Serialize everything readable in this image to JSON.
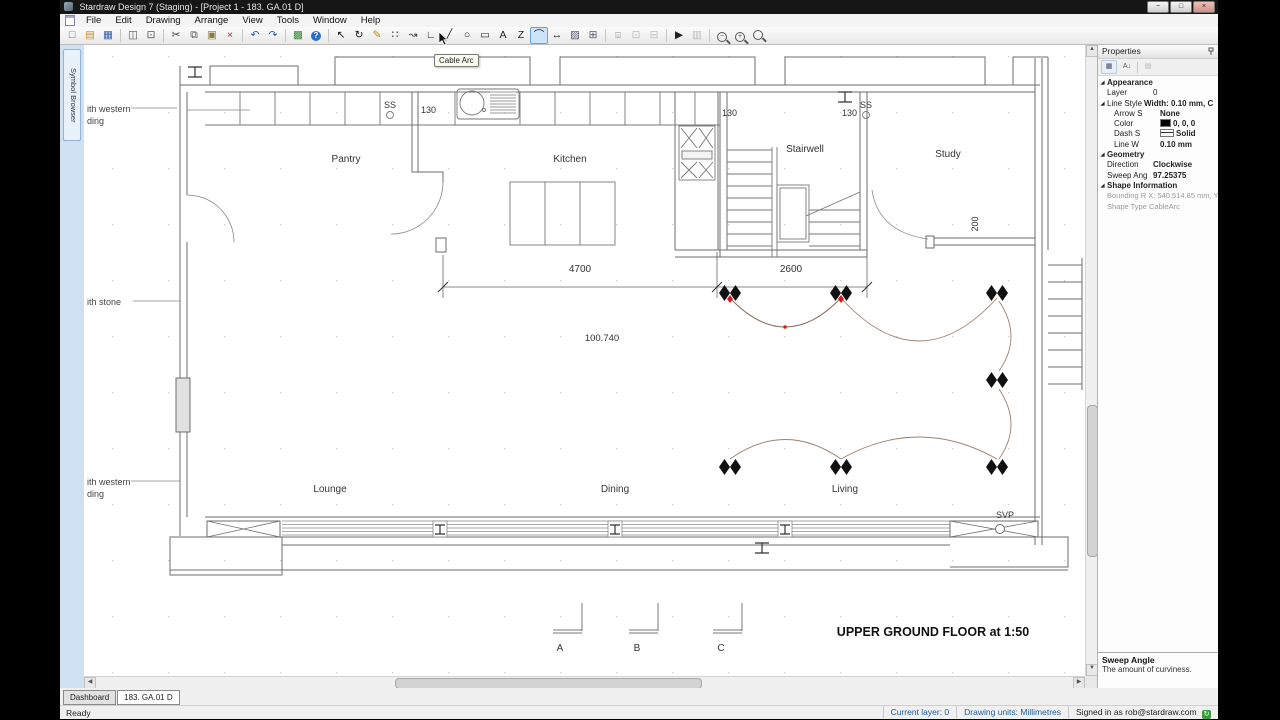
{
  "window": {
    "title": "Stardraw Design 7 (Staging) - [Project 1 - 183. GA.01 D]",
    "controls": {
      "minimize": "−",
      "maximize": "□",
      "close": "×"
    }
  },
  "menu": {
    "items": [
      "File",
      "Edit",
      "Drawing",
      "Arrange",
      "View",
      "Tools",
      "Window",
      "Help"
    ]
  },
  "toolbar": {
    "tooltip": "Cable Arc",
    "icons": [
      {
        "n": "new-icon",
        "g": "□",
        "c": "#666"
      },
      {
        "n": "open-icon",
        "g": "▤",
        "c": "#c8922e"
      },
      {
        "n": "save-icon",
        "g": "▦",
        "c": "#2f5fa8"
      },
      {
        "t": "sep"
      },
      {
        "n": "print-icon",
        "g": "◫",
        "c": "#555"
      },
      {
        "n": "print-preview-icon",
        "g": "⊡",
        "c": "#555"
      },
      {
        "t": "sep"
      },
      {
        "n": "cut-icon",
        "g": "✂",
        "c": "#444"
      },
      {
        "n": "copy-icon",
        "g": "⧉",
        "c": "#555"
      },
      {
        "n": "paste-icon",
        "g": "▣",
        "c": "#8a7a3a"
      },
      {
        "n": "delete-icon",
        "g": "×",
        "c": "#b03030"
      },
      {
        "t": "sep"
      },
      {
        "n": "undo-icon",
        "g": "↶",
        "c": "#2f5fa8"
      },
      {
        "n": "redo-icon",
        "g": "↷",
        "c": "#2f5fa8"
      },
      {
        "t": "sep"
      },
      {
        "n": "insert-picture-icon",
        "g": "▩",
        "c": "#3a8a3a"
      },
      {
        "n": "help-icon",
        "t": "help",
        "g": "?"
      },
      {
        "t": "sep"
      },
      {
        "n": "select-icon",
        "g": "↖",
        "c": "#111"
      },
      {
        "n": "rotate-icon",
        "g": "↻",
        "c": "#111"
      },
      {
        "n": "format-painter-icon",
        "g": "✎",
        "c": "#b8860b"
      },
      {
        "n": "node-edit-icon",
        "g": "∷",
        "c": "#333"
      },
      {
        "n": "curve-select-icon",
        "g": "↝",
        "c": "#333"
      },
      {
        "n": "corner-line-icon",
        "g": "∟",
        "c": "#222"
      },
      {
        "n": "line-icon",
        "g": "╱",
        "c": "#222"
      },
      {
        "n": "ellipse-icon",
        "g": "○",
        "c": "#222"
      },
      {
        "n": "rectangle-icon",
        "g": "▭",
        "c": "#222"
      },
      {
        "n": "text-icon",
        "g": "A",
        "c": "#222"
      },
      {
        "n": "polyline-icon",
        "g": "Z",
        "c": "#222"
      },
      {
        "n": "cable-arc-icon",
        "g": "⌒",
        "c": "#222",
        "active": true
      },
      {
        "n": "dimension-icon",
        "g": "↔",
        "c": "#222"
      },
      {
        "n": "image-icon",
        "g": "▨",
        "c": "#556"
      },
      {
        "n": "symbol-grid-icon",
        "g": "⊞",
        "c": "#556"
      },
      {
        "t": "sep"
      },
      {
        "n": "group-icon",
        "g": "⧈",
        "c": "#555",
        "dis": true
      },
      {
        "n": "ungroup-icon",
        "g": "⊡",
        "c": "#555",
        "dis": true
      },
      {
        "n": "regroup-icon",
        "g": "⊟",
        "c": "#555",
        "dis": true
      },
      {
        "t": "sep"
      },
      {
        "n": "pick-icon",
        "g": "▶",
        "c": "#222"
      },
      {
        "n": "measure-icon",
        "g": "▥",
        "c": "#555",
        "dis": true
      },
      {
        "t": "sep"
      },
      {
        "n": "zoom-out-icon",
        "t": "mag",
        "g": "−"
      },
      {
        "n": "zoom-in-icon",
        "t": "mag",
        "g": "+"
      },
      {
        "n": "zoom-window-icon",
        "t": "mag",
        "g": ""
      }
    ]
  },
  "symbol_browser": {
    "label": "Symbol Browser"
  },
  "properties": {
    "title": "Properties",
    "tools": {
      "categorized": "▦",
      "sort": "A↓",
      "pages": "▤"
    },
    "appearance": {
      "header": "Appearance",
      "layer_label": "Layer",
      "layer_value": "0",
      "linestyle_label": "Line Style",
      "linestyle_value": "Width: 0.10 mm, C",
      "arrow_label": "Arrow S",
      "arrow_value": "None",
      "color_label": "Color",
      "color_value": "0, 0, 0",
      "color_swatch": "#000000",
      "dash_label": "Dash S",
      "dash_value": "Solid",
      "linew_label": "Line W",
      "linew_value": "0.10 mm"
    },
    "geometry": {
      "header": "Geometry",
      "direction_label": "Direction",
      "direction_value": "Clockwise",
      "sweep_label": "Sweep Ang",
      "sweep_value": "97.25375"
    },
    "shape_info": {
      "header": "Shape Information",
      "bounding": "Bounding R X: 540,514.85 mm, Y:",
      "shape_type": "Shape Type CableArc"
    },
    "description_title": "Sweep Angle",
    "description_text": "The amount of curviness."
  },
  "plan": {
    "rooms": [
      "Pantry",
      "Kitchen",
      "Stairwell",
      "Study",
      "Lounge",
      "Dining",
      "Living"
    ],
    "dims": {
      "d4700": "4700",
      "d2600": "2600",
      "level": "100.740",
      "d130": "130",
      "d200": "200"
    },
    "labels": {
      "ss": "SS",
      "svp": "SVP"
    },
    "notes": [
      [
        "ith western",
        "ding"
      ],
      [
        "ith stone",
        ""
      ],
      [
        "ith western",
        "ding"
      ]
    ],
    "sections": [
      "A",
      "B",
      "C"
    ],
    "title": "UPPER GROUND FLOOR at 1:50"
  },
  "tabs": {
    "dashboard": "Dashboard",
    "drawing": "183. GA.01 D"
  },
  "status": {
    "ready": "Ready",
    "current_layer": "Current layer: 0",
    "units": "Drawing units: Millimetres",
    "signed_in": "Signed in as rob@stardraw.com"
  }
}
